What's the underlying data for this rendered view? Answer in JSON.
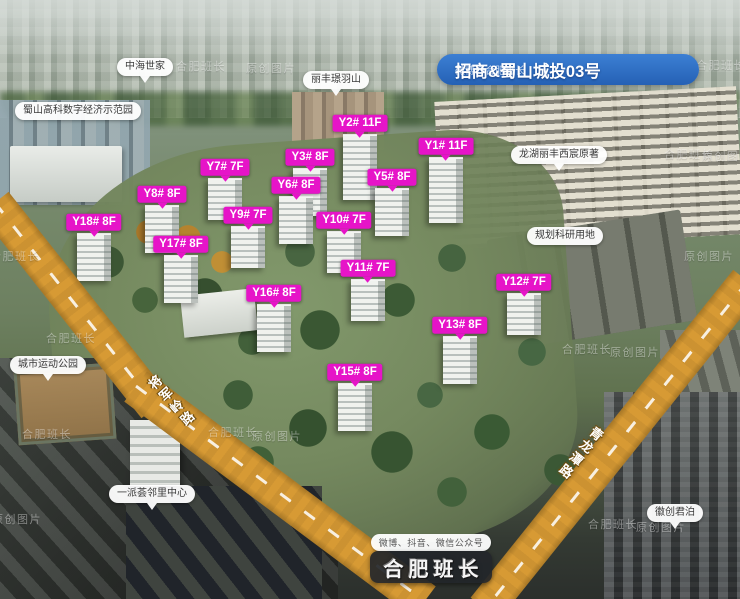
{
  "banner": {
    "title": "招商&蜀山城投03号",
    "subtitle": "微博@合肥班长"
  },
  "buildings": [
    {
      "label": "Y1# 11F",
      "x": 446,
      "y": 146,
      "floors": 11
    },
    {
      "label": "Y2# 11F",
      "x": 360,
      "y": 123,
      "floors": 11
    },
    {
      "label": "Y3# 8F",
      "x": 310,
      "y": 157,
      "floors": 8
    },
    {
      "label": "Y5# 8F",
      "x": 392,
      "y": 177,
      "floors": 8
    },
    {
      "label": "Y6# 8F",
      "x": 296,
      "y": 185,
      "floors": 8
    },
    {
      "label": "Y7# 7F",
      "x": 225,
      "y": 167,
      "floors": 7
    },
    {
      "label": "Y8# 8F",
      "x": 162,
      "y": 194,
      "floors": 8
    },
    {
      "label": "Y9# 7F",
      "x": 248,
      "y": 215,
      "floors": 7
    },
    {
      "label": "Y10# 7F",
      "x": 344,
      "y": 220,
      "floors": 7
    },
    {
      "label": "Y11# 7F",
      "x": 368,
      "y": 268,
      "floors": 7
    },
    {
      "label": "Y12# 7F",
      "x": 524,
      "y": 282,
      "floors": 7
    },
    {
      "label": "Y13# 8F",
      "x": 460,
      "y": 325,
      "floors": 8
    },
    {
      "label": "Y15# 8F",
      "x": 355,
      "y": 372,
      "floors": 8
    },
    {
      "label": "Y16# 8F",
      "x": 274,
      "y": 293,
      "floors": 8
    },
    {
      "label": "Y17# 8F",
      "x": 181,
      "y": 244,
      "floors": 8
    },
    {
      "label": "Y18# 8F",
      "x": 94,
      "y": 222,
      "floors": 8
    }
  ],
  "landmarks": [
    {
      "id": "zhonghai-shijia",
      "label": "中海世家",
      "x": 145,
      "y": 67,
      "pointer": true
    },
    {
      "id": "shushan-gaoke",
      "label": "蜀山高科数字经济示范园",
      "x": 78,
      "y": 111,
      "pointer": false
    },
    {
      "id": "lifeng-jingyushan",
      "label": "丽丰璟羽山",
      "x": 336,
      "y": 80,
      "pointer": true
    },
    {
      "id": "longhu-xichen",
      "label": "龙湖丽丰西宸原著",
      "x": 559,
      "y": 155,
      "pointer": true
    },
    {
      "id": "research-land",
      "label": "规划科研用地",
      "x": 565,
      "y": 236,
      "pointer": false
    },
    {
      "id": "sports-park",
      "label": "城市运动公园",
      "x": 48,
      "y": 365,
      "pointer": true
    },
    {
      "id": "yipaihui-center",
      "label": "一派荟邻里中心",
      "x": 152,
      "y": 494,
      "pointer": true
    },
    {
      "id": "huichuang-junbo",
      "label": "徽创君泊",
      "x": 675,
      "y": 513,
      "pointer": true
    }
  ],
  "roads": [
    {
      "name": "将军岭路",
      "side": "left"
    },
    {
      "name": "青龙潭路",
      "side": "right"
    }
  ],
  "watermarks": [
    {
      "text": "合肥班长",
      "x": 176,
      "y": 58
    },
    {
      "text": "原创图片",
      "x": 246,
      "y": 60
    },
    {
      "text": "合肥班长",
      "x": 696,
      "y": 57
    },
    {
      "text": "合肥班长",
      "x": 664,
      "y": 146
    },
    {
      "text": "原创图片",
      "x": 702,
      "y": 148
    },
    {
      "text": "合肥班长",
      "x": -10,
      "y": 248
    },
    {
      "text": "原创图片",
      "x": 684,
      "y": 248
    },
    {
      "text": "合肥班长",
      "x": 46,
      "y": 330
    },
    {
      "text": "合肥班长",
      "x": 562,
      "y": 341
    },
    {
      "text": "原创图片",
      "x": 610,
      "y": 344
    },
    {
      "text": "合肥班长",
      "x": 22,
      "y": 426
    },
    {
      "text": "合肥班长",
      "x": 208,
      "y": 424
    },
    {
      "text": "原创图片",
      "x": 252,
      "y": 428
    },
    {
      "text": "原创图片",
      "x": -8,
      "y": 511
    },
    {
      "text": "合肥班长",
      "x": 588,
      "y": 516
    },
    {
      "text": "原创图片",
      "x": 636,
      "y": 519
    }
  ],
  "footer": {
    "social": "微博、抖音、微信公众号",
    "brand": "合肥班长"
  },
  "colors": {
    "label_magenta": "#e614c8",
    "banner_blue": "#2f6fc4",
    "road_yellow": "#d79a34",
    "brand_pill_bg": "#24272b"
  }
}
